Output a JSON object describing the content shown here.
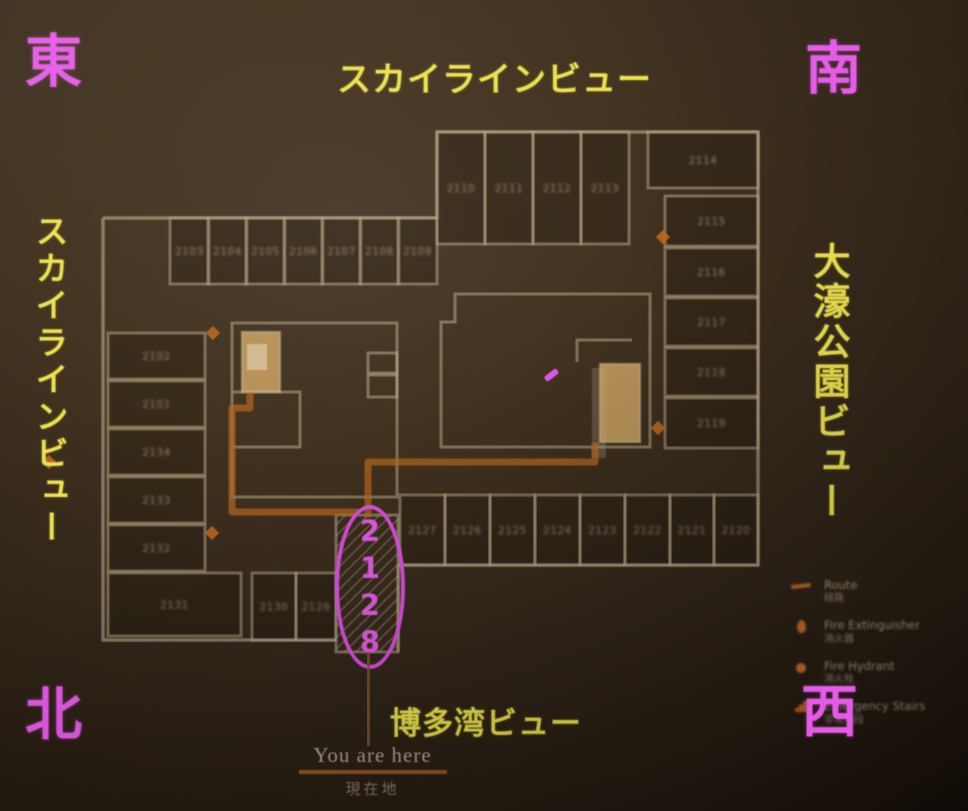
{
  "compass": {
    "top_left": "東",
    "top_right": "南",
    "bottom_left": "北",
    "bottom_right": "西"
  },
  "views": {
    "top": "スカイラインビュー",
    "left": "スカイラインビュー",
    "right": "大濠公園ビュー",
    "bottom": "博多湾ビュー"
  },
  "highlight": {
    "room": "2128",
    "digits": [
      "2",
      "1",
      "2",
      "8"
    ]
  },
  "you_are_here": {
    "en": "You are here",
    "ja": "現在地"
  },
  "legend": {
    "items": [
      {
        "icon": "route-line-icon",
        "en": "Route",
        "ja": "経路"
      },
      {
        "icon": "fire-extinguisher-icon",
        "en": "Fire Extinguisher",
        "ja": "消火器"
      },
      {
        "icon": "fire-hydrant-icon",
        "en": "Fire Hydrant",
        "ja": "消火栓"
      },
      {
        "icon": "emergency-stairs-icon",
        "en": "Emergency Stairs",
        "ja": "非常階段"
      }
    ]
  },
  "colors": {
    "magenta_annotation": "#e05ae6",
    "yellow_label": "#ece24e",
    "route_orange": "#b4661f",
    "wall_line": "#c8b795",
    "stair_fill": "#d9ad69"
  },
  "floor_plan": {
    "rooms": [
      {
        "label": "2103",
        "x": 170,
        "y": 218,
        "w": 39,
        "h": 66
      },
      {
        "label": "2104",
        "x": 208,
        "y": 218,
        "w": 39,
        "h": 66
      },
      {
        "label": "2105",
        "x": 246,
        "y": 218,
        "w": 39,
        "h": 66
      },
      {
        "label": "2106",
        "x": 284,
        "y": 218,
        "w": 39,
        "h": 66
      },
      {
        "label": "2107",
        "x": 322,
        "y": 218,
        "w": 39,
        "h": 66
      },
      {
        "label": "2108",
        "x": 360,
        "y": 218,
        "w": 39,
        "h": 66
      },
      {
        "label": "2109",
        "x": 398,
        "y": 218,
        "w": 39,
        "h": 66
      },
      {
        "label": "2110",
        "x": 437,
        "y": 132,
        "w": 48,
        "h": 112
      },
      {
        "label": "2111",
        "x": 485,
        "y": 132,
        "w": 48,
        "h": 112
      },
      {
        "label": "2112",
        "x": 533,
        "y": 132,
        "w": 48,
        "h": 112
      },
      {
        "label": "2113",
        "x": 581,
        "y": 132,
        "w": 48,
        "h": 112
      },
      {
        "label": "2114",
        "x": 648,
        "y": 132,
        "w": 110,
        "h": 56
      },
      {
        "label": "2115",
        "x": 665,
        "y": 196,
        "w": 93,
        "h": 50
      },
      {
        "label": "2116",
        "x": 665,
        "y": 248,
        "w": 93,
        "h": 48
      },
      {
        "label": "2117",
        "x": 665,
        "y": 298,
        "w": 93,
        "h": 48
      },
      {
        "label": "2118",
        "x": 665,
        "y": 348,
        "w": 93,
        "h": 48
      },
      {
        "label": "2119",
        "x": 665,
        "y": 398,
        "w": 93,
        "h": 50
      },
      {
        "label": "2127",
        "x": 400,
        "y": 495,
        "w": 45,
        "h": 70
      },
      {
        "label": "2126",
        "x": 445,
        "y": 495,
        "w": 45,
        "h": 70
      },
      {
        "label": "2125",
        "x": 490,
        "y": 495,
        "w": 45,
        "h": 70
      },
      {
        "label": "2124",
        "x": 535,
        "y": 495,
        "w": 45,
        "h": 70
      },
      {
        "label": "2123",
        "x": 580,
        "y": 495,
        "w": 45,
        "h": 70
      },
      {
        "label": "2122",
        "x": 625,
        "y": 495,
        "w": 45,
        "h": 70
      },
      {
        "label": "2121",
        "x": 670,
        "y": 495,
        "w": 44,
        "h": 70
      },
      {
        "label": "2120",
        "x": 714,
        "y": 495,
        "w": 44,
        "h": 70
      },
      {
        "label": "2130",
        "x": 252,
        "y": 573,
        "w": 44,
        "h": 67
      },
      {
        "label": "2129",
        "x": 296,
        "y": 573,
        "w": 40,
        "h": 67
      },
      {
        "label": "2131",
        "x": 108,
        "y": 573,
        "w": 133,
        "h": 63
      },
      {
        "label": "2102",
        "x": 108,
        "y": 333,
        "w": 97,
        "h": 46
      },
      {
        "label": "2101",
        "x": 108,
        "y": 381,
        "w": 97,
        "h": 46
      },
      {
        "label": "2134",
        "x": 108,
        "y": 429,
        "w": 97,
        "h": 46
      },
      {
        "label": "2133",
        "x": 108,
        "y": 477,
        "w": 97,
        "h": 46
      },
      {
        "label": "2132",
        "x": 108,
        "y": 525,
        "w": 97,
        "h": 46
      }
    ],
    "highlighted_room": {
      "x": 336,
      "y": 515,
      "w": 62,
      "h": 137
    },
    "stairs": [
      {
        "x": 242,
        "y": 332,
        "w": 38,
        "h": 60
      },
      {
        "x": 600,
        "y": 364,
        "w": 40,
        "h": 78
      }
    ],
    "route": [
      [
        [
          355,
          512
        ],
        [
          232,
          512
        ],
        [
          232,
          408
        ],
        [
          250,
          408
        ],
        [
          250,
          396
        ]
      ],
      [
        [
          368,
          514
        ],
        [
          368,
          462
        ],
        [
          595,
          462
        ],
        [
          595,
          446
        ]
      ]
    ],
    "markers": [
      [
        213,
        333
      ],
      [
        49,
        462
      ],
      [
        663,
        237
      ],
      [
        658,
        428
      ],
      [
        212,
        533
      ]
    ]
  }
}
